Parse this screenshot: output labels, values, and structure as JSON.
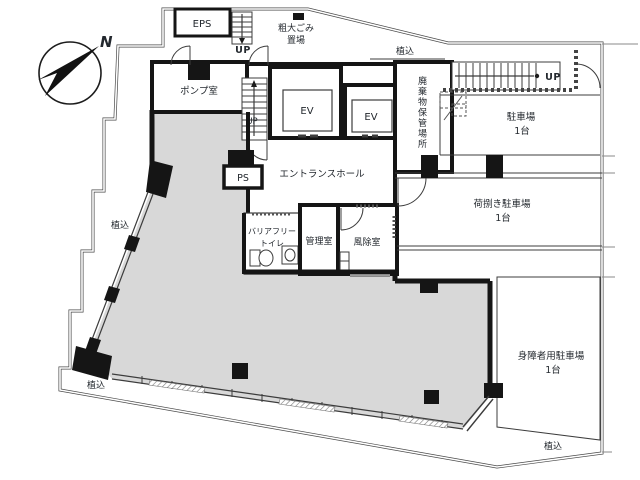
{
  "compass": {
    "north_label": "N"
  },
  "rooms": {
    "eps": "EPS",
    "bulky_garbage_l1": "粗大ごみ",
    "bulky_garbage_l2": "置場",
    "pump_room": "ポンプ室",
    "elevator_1": "EV",
    "elevator_2": "EV",
    "waste_storage": "廃棄物保管場所",
    "entrance_hall": "エントランスホール",
    "pipe_shaft": "PS",
    "accessible_toilet_l1": "バリアフリー",
    "accessible_toilet_l2": "トイレ",
    "manager_room": "管理室",
    "windbreak_room": "風除室"
  },
  "stairs": {
    "up_top": "UP",
    "up_hall": "UP",
    "up_right": "UP"
  },
  "parking": {
    "general": {
      "name": "駐車場",
      "capacity": "1台"
    },
    "loading": {
      "name": "荷捌き駐車場",
      "capacity": "1台"
    },
    "accessible": {
      "name": "身障者用駐車場",
      "capacity": "1台"
    }
  },
  "planting": {
    "top": "植込",
    "left": "植込",
    "bottom_left": "植込",
    "bottom_right": "植込"
  },
  "colors": {
    "floor_fill": "#d8d8d8",
    "wall": "#151515",
    "line": "#3c3c3c",
    "boundary": "#4a4a4a",
    "text": "#23282e"
  }
}
